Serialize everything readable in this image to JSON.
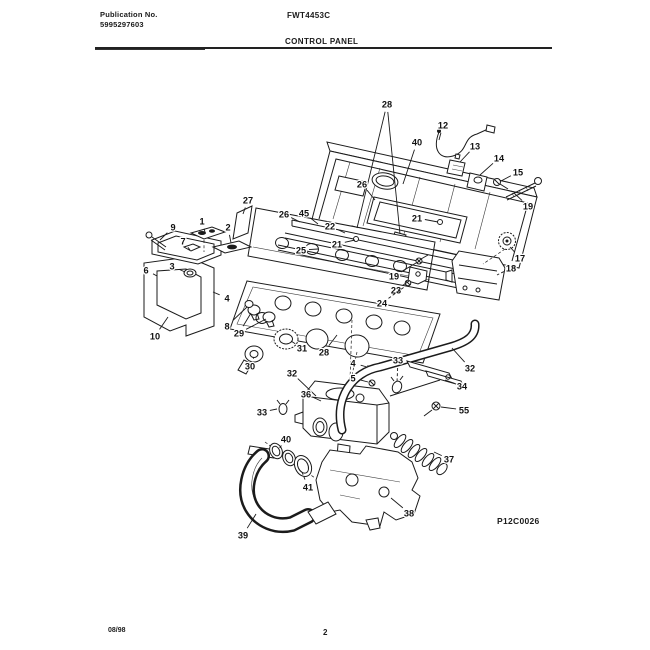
{
  "page": {
    "publication_label": "Publication No.",
    "publication_number": "5995297603",
    "model_number": "FWT4453C",
    "section_title": "CONTROL PANEL",
    "diagram_id": "P12C0026",
    "date_code": "08/98",
    "page_number": "2"
  },
  "colors": {
    "ink": "#1b1b1b",
    "paper": "#ffffff"
  },
  "diagram": {
    "type": "exploded-parts-view",
    "subject": "washer control panel assembly",
    "callouts": [
      {
        "n": "28",
        "x": 387,
        "y": 104,
        "tx": 357,
        "ty": 228,
        "tx2": 400,
        "ty2": 234
      },
      {
        "n": "12",
        "x": 443,
        "y": 125,
        "tx": 439,
        "ty": 140
      },
      {
        "n": "40",
        "x": 417,
        "y": 142,
        "tx": 403,
        "ty": 184
      },
      {
        "n": "13",
        "x": 475,
        "y": 146,
        "tx": 460,
        "ty": 162
      },
      {
        "n": "14",
        "x": 499,
        "y": 158,
        "tx": 480,
        "ty": 175
      },
      {
        "n": "15",
        "x": 518,
        "y": 172,
        "tx": 501,
        "ty": 181
      },
      {
        "n": "19",
        "x": 528,
        "y": 206,
        "tx": 514,
        "ty": 193
      },
      {
        "n": "17",
        "x": 520,
        "y": 258,
        "tx": 510,
        "ty": 247
      },
      {
        "n": "18",
        "x": 511,
        "y": 268,
        "tx": 497,
        "ty": 275,
        "dash": true
      },
      {
        "n": "27",
        "x": 248,
        "y": 200,
        "tx": 243,
        "ty": 214
      },
      {
        "n": "26",
        "x": 284,
        "y": 214,
        "tx": 300,
        "ty": 222
      },
      {
        "n": "45",
        "x": 304,
        "y": 213,
        "tx": 318,
        "ty": 224
      },
      {
        "n": "26",
        "x": 362,
        "y": 184,
        "tx": 375,
        "ty": 200
      },
      {
        "n": "22",
        "x": 330,
        "y": 226,
        "tx": 345,
        "ty": 233
      },
      {
        "n": "21",
        "x": 337,
        "y": 244,
        "tx": 355,
        "ty": 240
      },
      {
        "n": "21",
        "x": 417,
        "y": 218,
        "tx": 438,
        "ty": 222
      },
      {
        "n": "25",
        "x": 301,
        "y": 250,
        "tx": 318,
        "ty": 249
      },
      {
        "n": "19",
        "x": 394,
        "y": 276,
        "tx": 416,
        "ty": 263
      },
      {
        "n": "23",
        "x": 396,
        "y": 290,
        "tx": 409,
        "ty": 281
      },
      {
        "n": "24",
        "x": 382,
        "y": 303,
        "tx": 407,
        "ty": 285,
        "dash": true
      },
      {
        "n": "9",
        "x": 173,
        "y": 227,
        "tx": 160,
        "ty": 240
      },
      {
        "n": "1",
        "x": 202,
        "y": 221,
        "tx": 205,
        "ty": 232
      },
      {
        "n": "2",
        "x": 228,
        "y": 227,
        "tx": 231,
        "ty": 243
      },
      {
        "n": "7",
        "x": 183,
        "y": 241,
        "tx": 190,
        "ty": 250
      },
      {
        "n": "3",
        "x": 172,
        "y": 266,
        "tx": 185,
        "ty": 272
      },
      {
        "n": "6",
        "x": 146,
        "y": 270,
        "tx": 157,
        "ty": 276
      },
      {
        "n": "4",
        "x": 227,
        "y": 298,
        "tx": 213,
        "ty": 292
      },
      {
        "n": "10",
        "x": 155,
        "y": 336,
        "tx": 168,
        "ty": 317
      },
      {
        "n": "8",
        "x": 227,
        "y": 326,
        "tx": 247,
        "ty": 307
      },
      {
        "n": "29",
        "x": 239,
        "y": 333,
        "tx": 251,
        "ty": 313,
        "tx2": 266,
        "ty2": 319
      },
      {
        "n": "30",
        "x": 250,
        "y": 366,
        "tx": 254,
        "ty": 357
      },
      {
        "n": "31",
        "x": 302,
        "y": 348,
        "tx": 291,
        "ty": 341
      },
      {
        "n": "28",
        "x": 324,
        "y": 352,
        "tx": 337,
        "ty": 335
      },
      {
        "n": "32",
        "x": 292,
        "y": 373,
        "tx": 316,
        "ty": 396
      },
      {
        "n": "33",
        "x": 262,
        "y": 412,
        "tx": 277,
        "ty": 409
      },
      {
        "n": "33",
        "x": 398,
        "y": 360,
        "tx": 397,
        "ty": 382,
        "dash": true
      },
      {
        "n": "4",
        "x": 353,
        "y": 363,
        "tx": 367,
        "ty": 367
      },
      {
        "n": "5",
        "x": 353,
        "y": 378,
        "tx": 368,
        "ty": 382
      },
      {
        "n": "32",
        "x": 470,
        "y": 368,
        "tx": 452,
        "ty": 348
      },
      {
        "n": "34",
        "x": 462,
        "y": 386,
        "tx": 445,
        "ty": 380
      },
      {
        "n": "55",
        "x": 464,
        "y": 410,
        "tx": 441,
        "ty": 407
      },
      {
        "n": "36",
        "x": 306,
        "y": 394,
        "tx": 321,
        "ty": 401
      },
      {
        "n": "37",
        "x": 449,
        "y": 459,
        "tx": 434,
        "ty": 452
      },
      {
        "n": "38",
        "x": 409,
        "y": 513,
        "tx": 391,
        "ty": 498
      },
      {
        "n": "39",
        "x": 243,
        "y": 535,
        "tx": 256,
        "ty": 514
      },
      {
        "n": "40",
        "x": 286,
        "y": 439,
        "tx": 279,
        "ty": 449,
        "dash": true
      },
      {
        "n": "41",
        "x": 308,
        "y": 487,
        "tx": 302,
        "ty": 472,
        "dash": true
      }
    ]
  }
}
